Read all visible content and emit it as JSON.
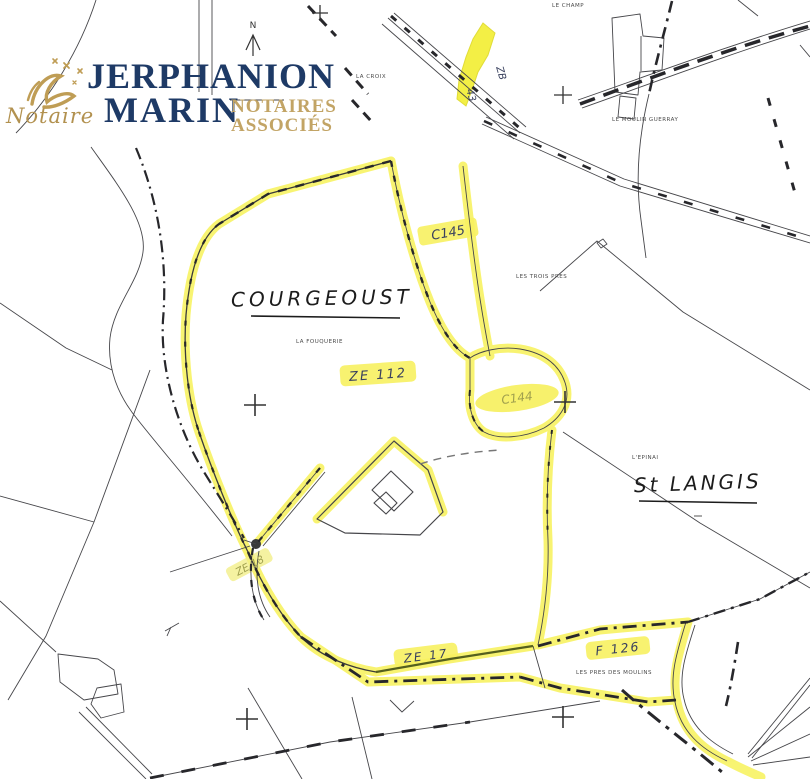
{
  "logo": {
    "notaire": "Notaire",
    "name1": "JERPHANION",
    "name2": "MARIN",
    "tag1": "NOTAIRES",
    "tag2": "ASSOCIÉS"
  },
  "map": {
    "north": "N",
    "places": {
      "courgeoust": "COURGEOUST",
      "st_langis": "St LANGIS"
    },
    "parcels": {
      "zb": "ZB",
      "n43": "43",
      "c145": "C145",
      "ze112": "ZE 112",
      "c144": "C144",
      "ze18": "ZE 18",
      "ze17": "ZE 17",
      "f126": "F 126"
    },
    "lieux": {
      "le_champ": "LE CHAMP",
      "la_croix": "LA CROIX",
      "le_moulin": "LE MOULIN GUERRAY",
      "les_trois": "LES TROIS PRES",
      "la_fouquerie": "LA FOUQUERIE",
      "l_epinai": "L'EPINAI",
      "les_pres": "LES PRES DES MOULINS"
    }
  },
  "colors": {
    "highlight": "#f7f259",
    "parcel_fill": "#f3ef45",
    "logo_navy": "#1e3a66",
    "logo_gold": "#c2a465",
    "map_ink": "#3a3a3a"
  }
}
